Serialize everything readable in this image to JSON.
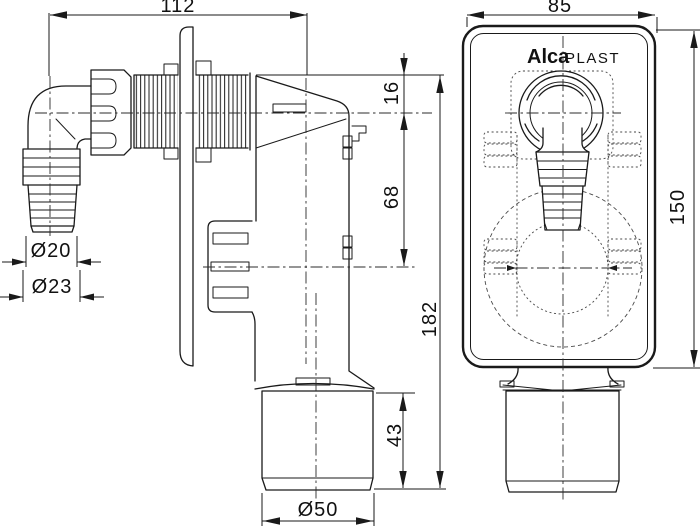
{
  "drawing": {
    "type": "technical-drawing",
    "colors": {
      "background": "#ffffff",
      "line": "#1a1a1a"
    },
    "logo": {
      "bold": "Alca",
      "regular": "PLAST"
    },
    "dimensions": {
      "overall_width": "112",
      "faceplate_width": "85",
      "inlet_center_offset": "16",
      "center_spacing": "68",
      "overall_height": "182",
      "outlet_spigot_length": "43",
      "faceplate_height": "150",
      "hose_barb_inner_diameter": "Ø20",
      "hose_barb_outer_diameter": "Ø23",
      "outlet_diameter": "Ø50"
    }
  }
}
